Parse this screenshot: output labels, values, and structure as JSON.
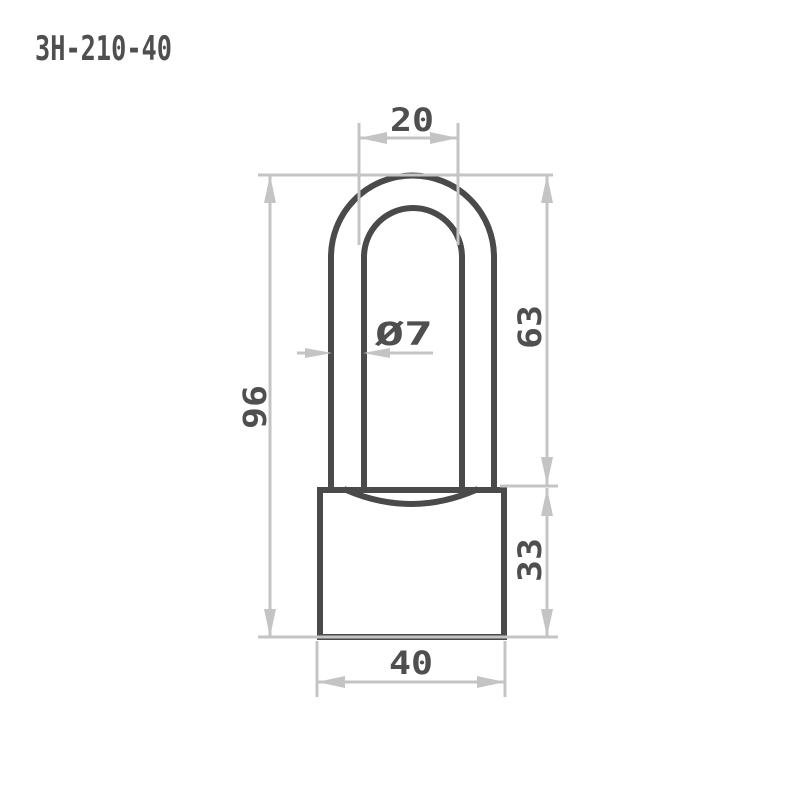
{
  "title": "ЗН-210-40",
  "drawing": {
    "type": "technical-dimension-drawing",
    "subject": "padlock-front-view",
    "units": "mm",
    "colors": {
      "object_line": "#4a4a4a",
      "dimension_line": "#c4c4c4",
      "text": "#4f4f4f",
      "background": "#ffffff"
    },
    "dimensions": {
      "shackle_inner_width": {
        "label": "20",
        "value": 20
      },
      "shackle_wire_diameter": {
        "label": "Ø7",
        "value": 7
      },
      "shackle_height": {
        "label": "63",
        "value": 63
      },
      "overall_height": {
        "label": "96",
        "value": 96
      },
      "body_height": {
        "label": "33",
        "value": 33
      },
      "body_width": {
        "label": "40",
        "value": 40
      }
    }
  }
}
